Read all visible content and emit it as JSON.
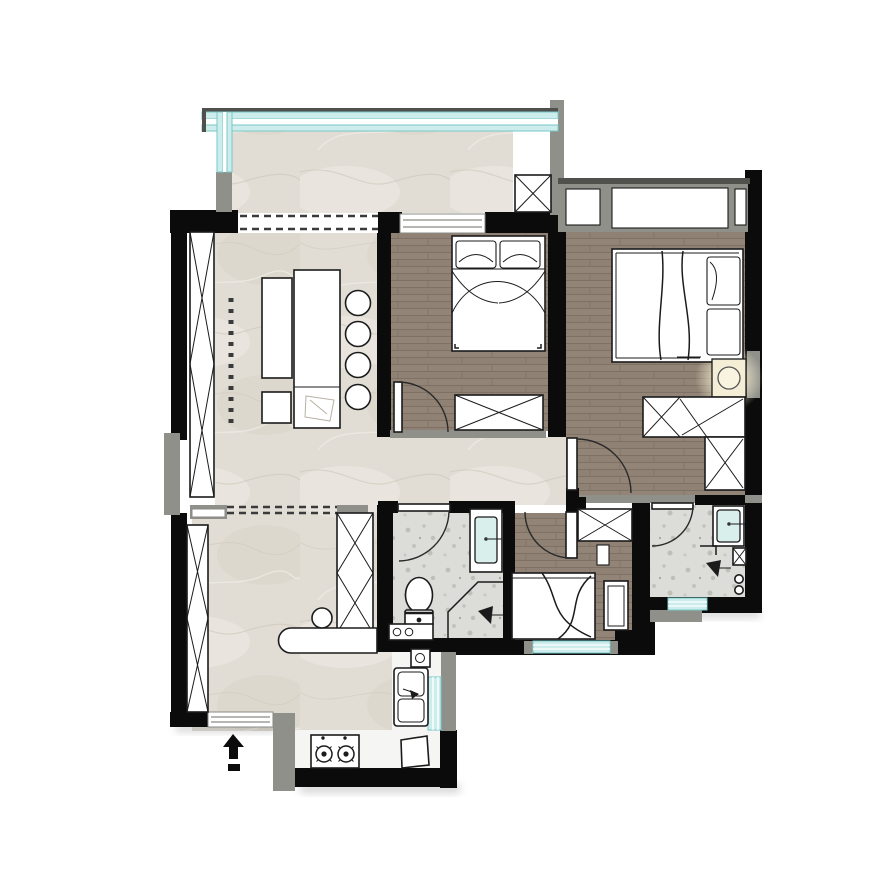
{
  "plan": {
    "type": "residential-apartment-floor-plan",
    "rooms": [
      {
        "id": "balcony",
        "floor": "marble",
        "features": [
          "glazed-railing",
          "structural-column",
          "dashed-opening-to-living"
        ]
      },
      {
        "id": "living-dining",
        "floor": "marble",
        "features": [
          "island-counter",
          "four-round-stools",
          "tall-storage-cabinets",
          "bar-counter",
          "round-stool",
          "dashed-ceiling-line"
        ]
      },
      {
        "id": "hallway",
        "floor": "marble",
        "features": [
          "threshold-sill"
        ]
      },
      {
        "id": "bedroom-1",
        "floor": "wood",
        "features": [
          "double-bed",
          "wardrobe",
          "swing-door",
          "window-to-balcony"
        ]
      },
      {
        "id": "bedroom-2",
        "floor": "wood",
        "features": [
          "double-bed",
          "nightstand-with-lamp",
          "l-shaped-wardrobe",
          "swing-door",
          "bay-window"
        ]
      },
      {
        "id": "bedroom-3",
        "floor": "wood",
        "features": [
          "single-bed",
          "nightstand",
          "wardrobe",
          "shelf",
          "swing-door",
          "window"
        ]
      },
      {
        "id": "bathroom-1",
        "floor": "terrazzo",
        "features": [
          "toilet",
          "vanity-basin",
          "corner-shower",
          "washer",
          "swing-door"
        ]
      },
      {
        "id": "bathroom-2",
        "floor": "terrazzo",
        "features": [
          "vanity-basin",
          "shower",
          "column",
          "swing-door",
          "window"
        ]
      },
      {
        "id": "kitchen",
        "floor": "tile",
        "features": [
          "double-basin-sink",
          "two-burner-stove",
          "appliance-box",
          "window"
        ]
      },
      {
        "id": "entry",
        "features": [
          "entry-direction-arrow",
          "threshold"
        ]
      }
    ],
    "symbols": [
      "entry-direction-arrow",
      "door-swing-arc",
      "dashed-opening",
      "column-x-mark",
      "wardrobe-x-mark",
      "shower-head",
      "faucet"
    ]
  },
  "colors": {
    "background": "#ffffff",
    "wall": "#0b0b0b",
    "structureGray": "#90908a",
    "structureDark": "#50504c",
    "marble": "#e1ddd5",
    "marbleVein": "#cdc6b8",
    "marbleLight": "#eeebe5",
    "wood": "#8f8174",
    "woodDark": "#786c5f",
    "woodLight": "#a09487",
    "terrazzo": "#dcdcd8",
    "terrazzoSpeck": "#b2b2ac",
    "kitchenFloor": "#f5f5f3",
    "glazing": "#cdecec",
    "glazingLine": "#79c7c7",
    "furnitureLine": "#1b1b1b",
    "furnitureFill": "#ffffff",
    "doorArc": "#2a2a2a",
    "dashLine": "#3a3a3a",
    "lamp": "#f4eed6",
    "lampGlow": "#fcf5d5",
    "basin": "#d8efec",
    "sketch": "#b7b1a4"
  }
}
